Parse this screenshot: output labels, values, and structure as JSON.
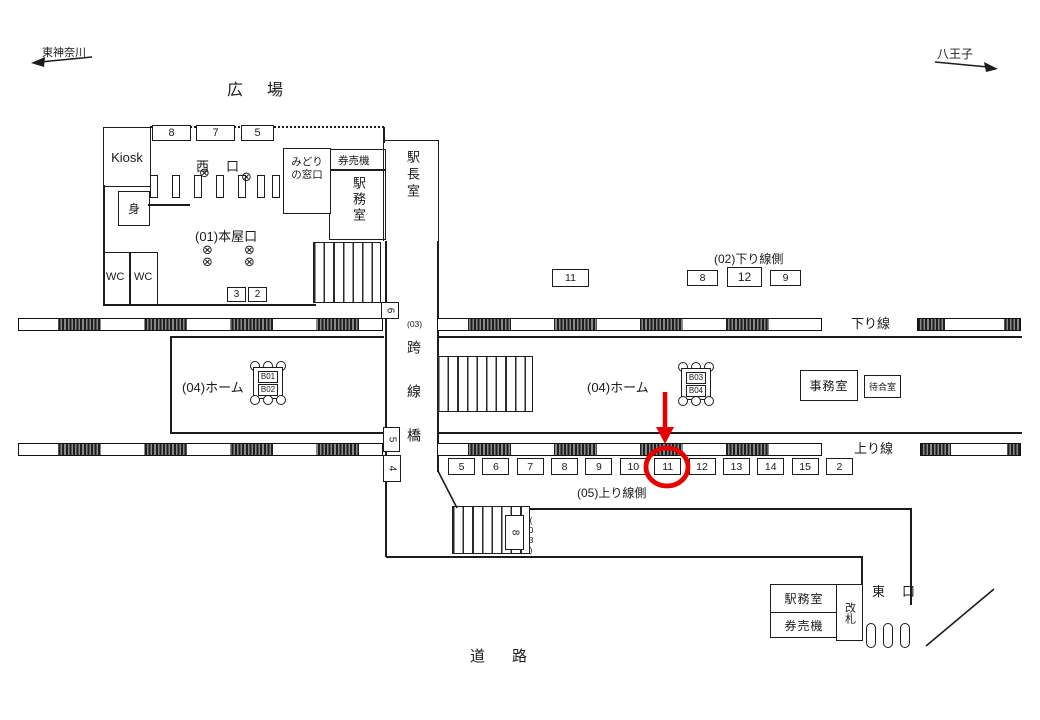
{
  "accent_red": "#e60000",
  "header": {
    "direction_left": "東神奈川",
    "direction_right": "八王子",
    "plaza": "広　場"
  },
  "west_building": {
    "kiosk": "Kiosk",
    "top_ads": [
      "8",
      "7",
      "5"
    ],
    "west_exit": "西　口",
    "body_box": "身",
    "wc_left": "WC",
    "wc_right": "WC",
    "honya_entrance": "(01)本屋口",
    "bottom_ads": [
      "3",
      "2"
    ],
    "midori_line1": "みどり",
    "midori_line2": "の窓口",
    "ticket_machines": "券売機",
    "station_office": "駅務室",
    "master_office": "駅長室",
    "gate_wheel_icon": "⊗"
  },
  "bridge": {
    "code": "(03)",
    "label": "跨線橋",
    "ads": [
      "6",
      "5",
      "4"
    ]
  },
  "tracks": {
    "down_label": "下り線",
    "up_label": "上り線"
  },
  "platform": {
    "label_west": "(04)ホーム",
    "label_east": "(04)ホーム",
    "bench_west": [
      "B01",
      "B02"
    ],
    "bench_east": [
      "B03",
      "B04"
    ],
    "office": "事務室",
    "waiting_room": "待合室"
  },
  "ads_down_side": {
    "label": "(02)下り線側",
    "items": [
      "11",
      "8",
      "12",
      "9"
    ]
  },
  "ads_up_side": {
    "label": "(05)上り線側",
    "items": [
      "5",
      "6",
      "7",
      "8",
      "9",
      "10",
      "11",
      "12",
      "13",
      "14",
      "15",
      "2"
    ],
    "highlighted": "11"
  },
  "lower_stairs": {
    "ad": "8",
    "code": "(03)"
  },
  "east_building": {
    "station_office": "駅務室",
    "ticket_machines": "券売機",
    "gate": "改札",
    "east_exit": "東　口"
  },
  "road": "道　路"
}
